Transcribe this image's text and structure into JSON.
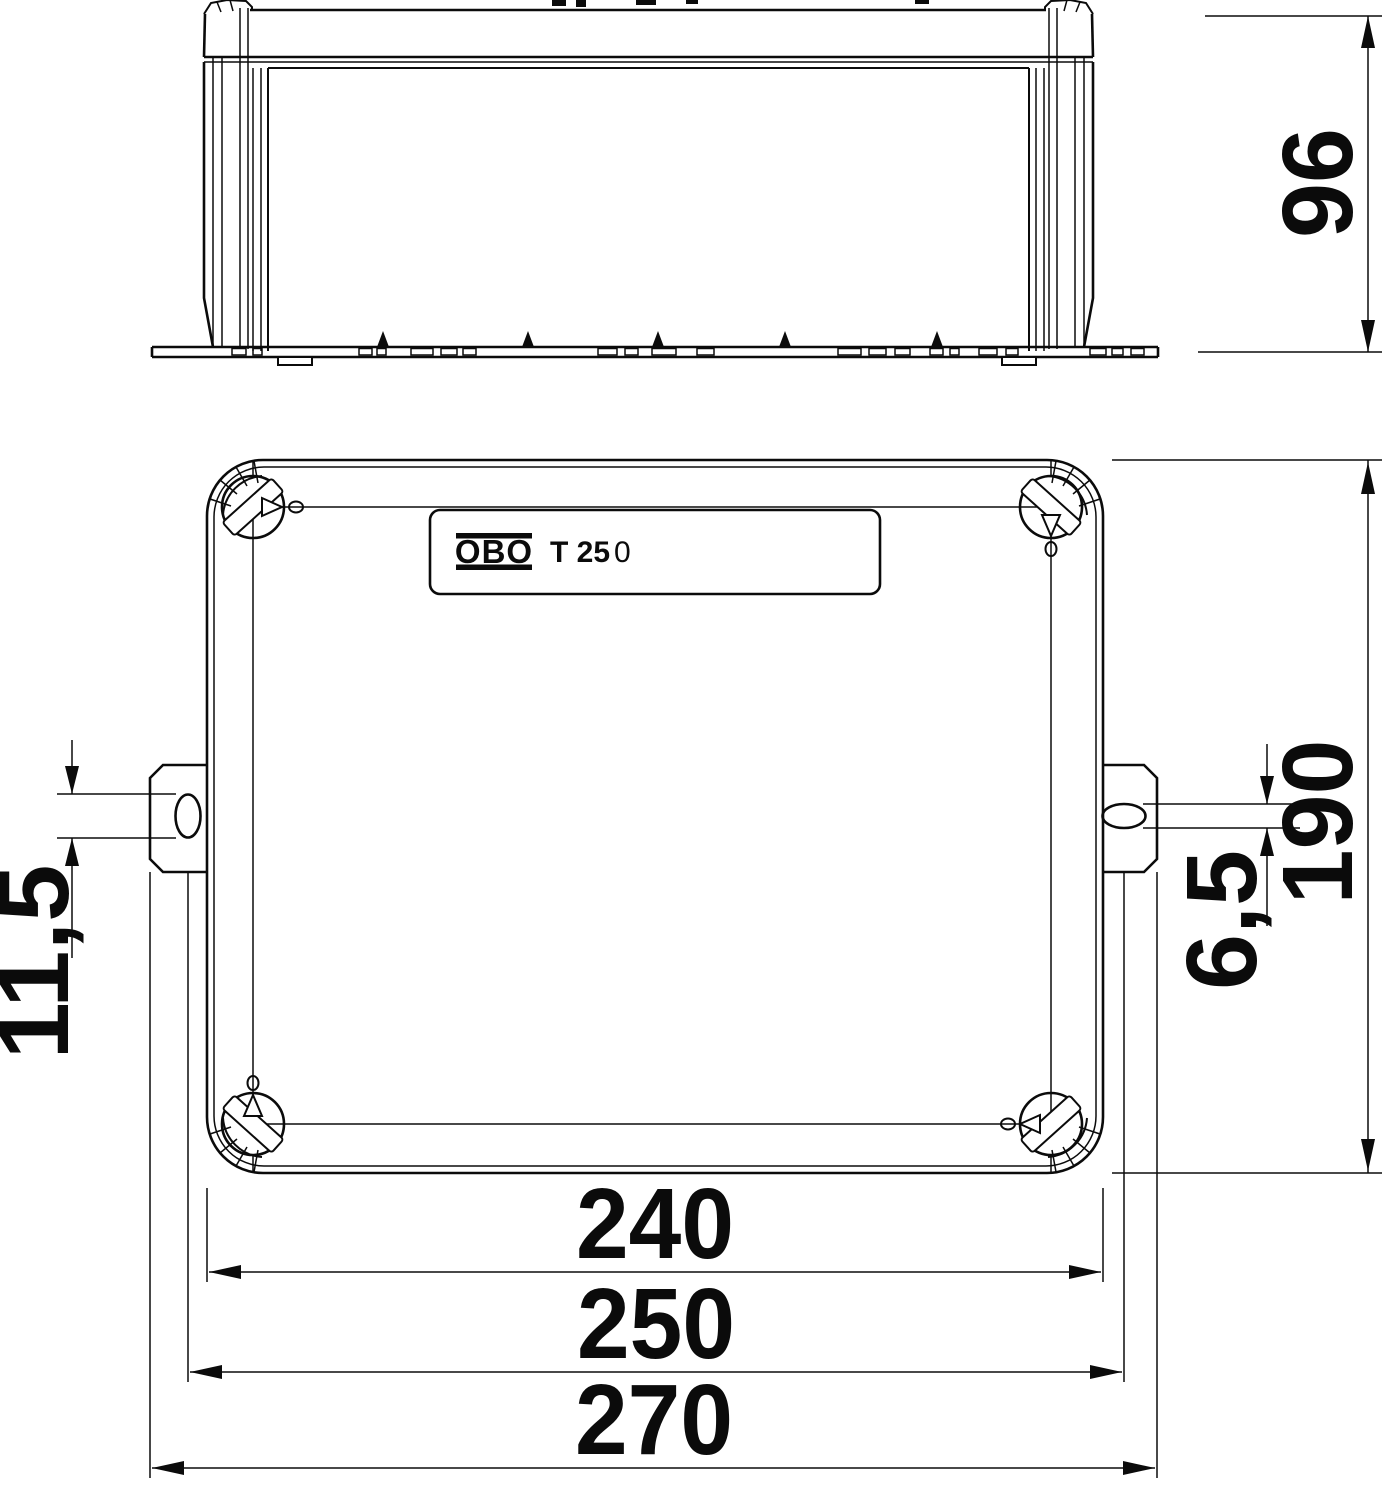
{
  "drawing": {
    "type": "technical-dimension-drawing",
    "colors": {
      "line": "#0b0b0b",
      "background": "#ffffff"
    },
    "side_view": {
      "height_dim": "96"
    },
    "plan_view": {
      "label_plate": {
        "brand": "OBO",
        "model": "T 25",
        "model_suffix": "0"
      },
      "height_dim": "190",
      "slot_length_dim": "11,5",
      "slot_width_dim": "6,5",
      "bottom_dims": {
        "lid_width": "240",
        "mounting_centers": "250",
        "overall_width": "270"
      }
    }
  }
}
